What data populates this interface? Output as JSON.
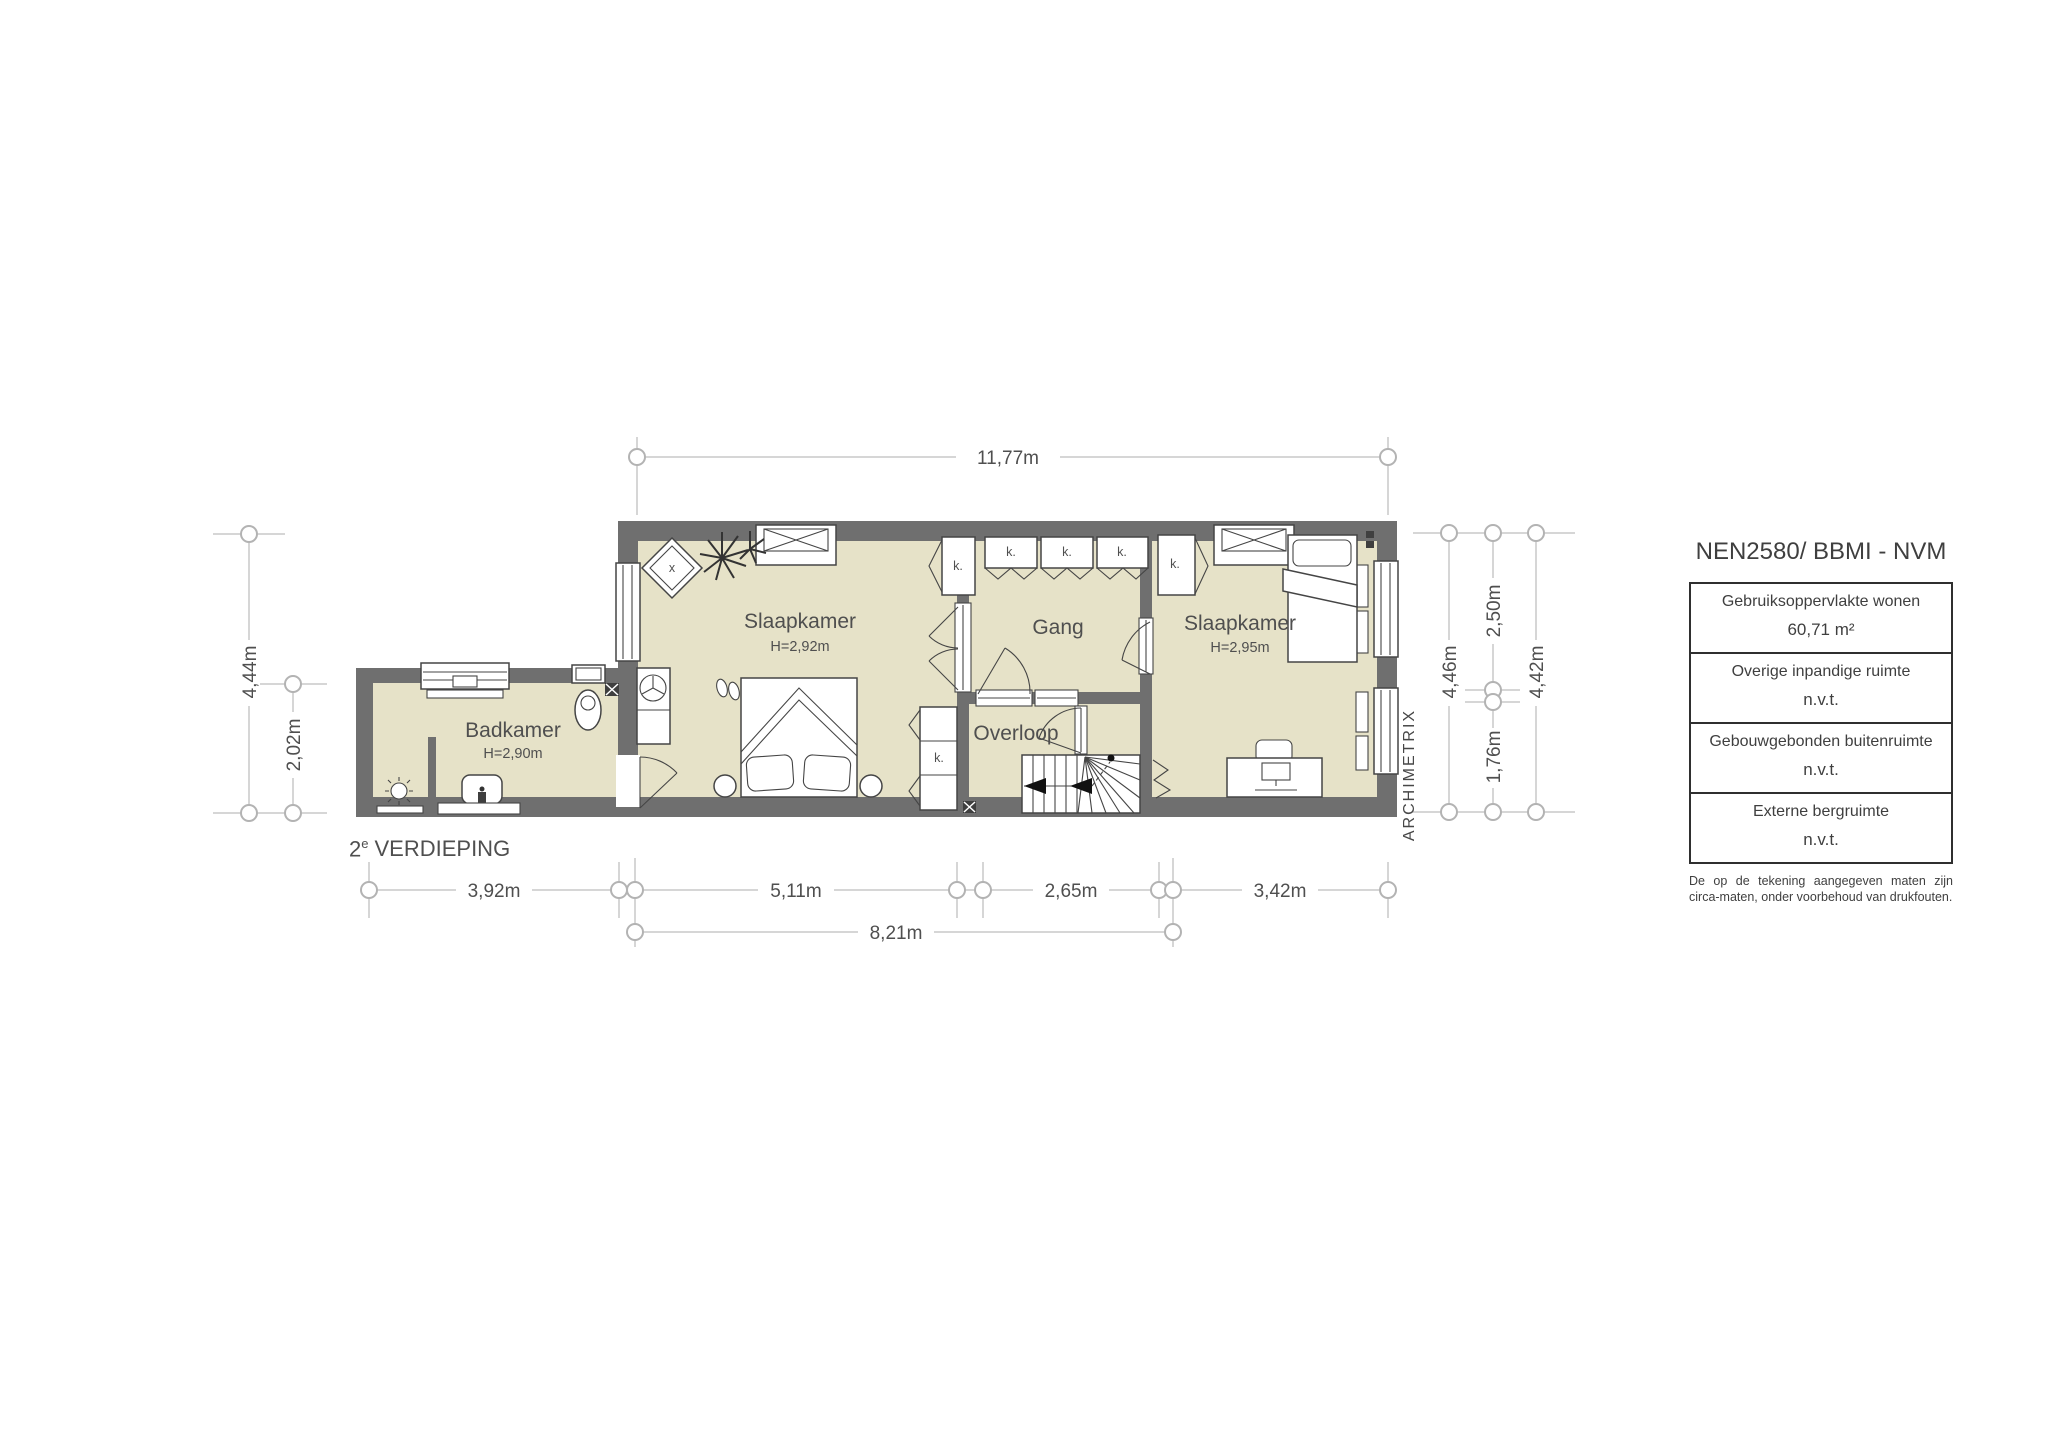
{
  "plan": {
    "floor_label": {
      "num": "2",
      "sup": "e",
      "rest": "VERDIEPING"
    },
    "rooms": {
      "slaapkamer1": {
        "name": "Slaapkamer",
        "height": "H=2,92m"
      },
      "slaapkamer2": {
        "name": "Slaapkamer",
        "height": "H=2,95m"
      },
      "badkamer": {
        "name": "Badkamer",
        "height": "H=2,90m"
      },
      "gang": {
        "name": "Gang"
      },
      "overloop": {
        "name": "Overloop"
      }
    },
    "closet": "k.",
    "diamond_mark": "x",
    "dims": {
      "top": "11,77m",
      "bottom": [
        "3,92m",
        "5,11m",
        "2,65m",
        "3,42m"
      ],
      "total": "8,21m",
      "left": [
        "4,44m",
        "2,02m"
      ],
      "right": [
        "4,46m",
        "2,50m",
        "1,76m",
        "4,42m"
      ]
    },
    "branding": "ARCHIMETRIX"
  },
  "legend": {
    "title": "NEN2580/ BBMI - NVM",
    "rows": [
      {
        "label": "Gebruiksoppervlakte wonen",
        "value": "60,71 m²"
      },
      {
        "label": "Overige inpandige ruimte",
        "value": "n.v.t."
      },
      {
        "label": "Gebouwgebonden buitenruimte",
        "value": "n.v.t."
      },
      {
        "label": "Externe bergruimte",
        "value": "n.v.t."
      }
    ],
    "disclaimer": "De op de tekening aangegeven maten zijn circa-maten, onder voorbehoud van drukfouten."
  },
  "colors": {
    "floor": "#e6e2c8",
    "wall": "#6f6f6f",
    "dimline": "#c9c9c9",
    "text": "#4f4f4f"
  }
}
